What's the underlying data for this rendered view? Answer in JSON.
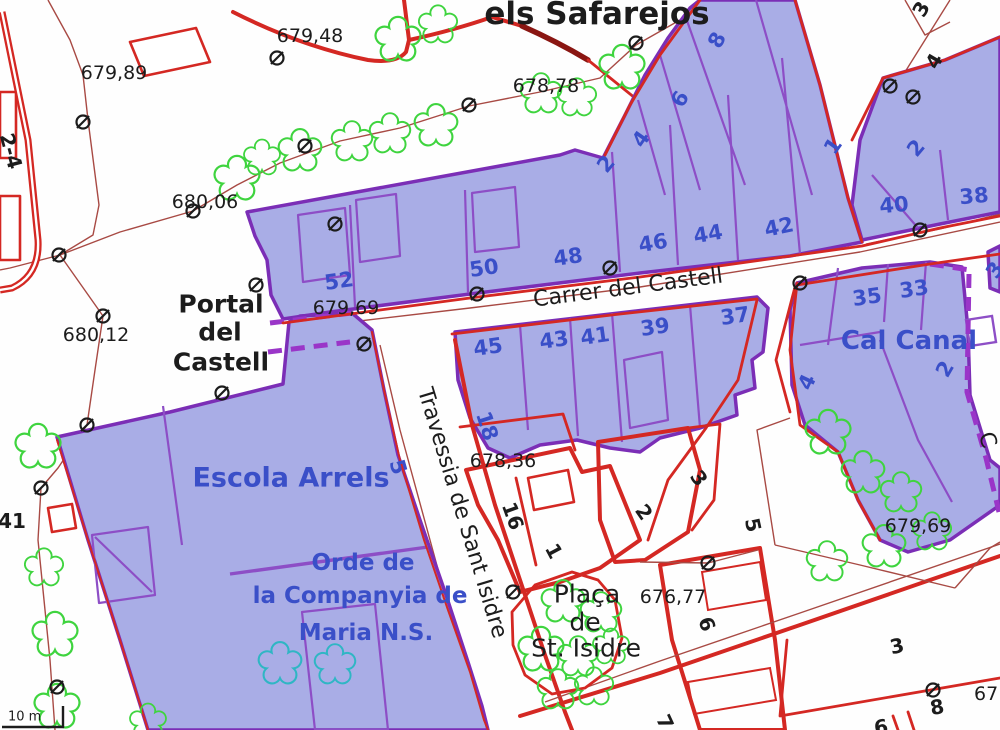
{
  "colors": {
    "parcel_fill": "#a9ade6",
    "parcel_stroke": "#7b2eb6",
    "parcel_inner": "#8d4ec6",
    "dashed_purple": "#9a35c8",
    "road_red": "#d42823",
    "contour_red": "#a84a44",
    "dark_red": "#8a1612",
    "tree_green": "#3fd43f",
    "tree_teal": "#2fb6c4",
    "label_blue": "#3a4fc8",
    "label_black": "#1c1c1c"
  },
  "labels": {
    "title": "els Safarejos",
    "portal_1": "Portal",
    "portal_2": "del",
    "portal_3": "Castell",
    "placa_1": "Plaça",
    "placa_2": "de",
    "placa_3": "St. Isidre",
    "street_carrer": "Carrer del Castell",
    "street_travessia": "Travessia de Sant Isidre",
    "street_partial": "C",
    "escola": "Escola Arrels",
    "orde_1": "Orde de",
    "orde_2": "la Companyia de",
    "orde_3": "Maria N.S.",
    "cal_canal": "Cal Canal",
    "scale": "10 m",
    "elevations": {
      "e0": "679,48",
      "e1": "679,89",
      "e2": "678,78",
      "e3": "680,06",
      "e4": "680,12",
      "e5": "679,69",
      "e6": "678,36",
      "e7": "676,77",
      "e8": "679,69",
      "e9": "67"
    },
    "house_numbers_blue": {
      "h52": "52",
      "h50": "50",
      "h48": "48",
      "h46": "46",
      "h44": "44",
      "h42": "42",
      "h2w": "2",
      "h4w": "4",
      "h6w": "6",
      "h8w": "8",
      "h1": "1",
      "h2r": "2",
      "h40": "40",
      "h38": "38",
      "h45": "45",
      "h43": "43",
      "h41": "41",
      "h39": "39",
      "h37": "37",
      "h35": "35",
      "h33": "33",
      "h2c": "2",
      "h4c": "4",
      "h18": "18",
      "h5": "5",
      "h3r": "3"
    },
    "house_numbers_black": {
      "k24": "2-4",
      "k41": "41",
      "k3t": "3",
      "k4t": "4",
      "k16": "16",
      "k1": "1",
      "k2": "2",
      "k3m": "3",
      "k5": "5",
      "k6a": "6",
      "k7": "7",
      "k3b": "3",
      "k8": "8",
      "k6b": "6"
    }
  }
}
